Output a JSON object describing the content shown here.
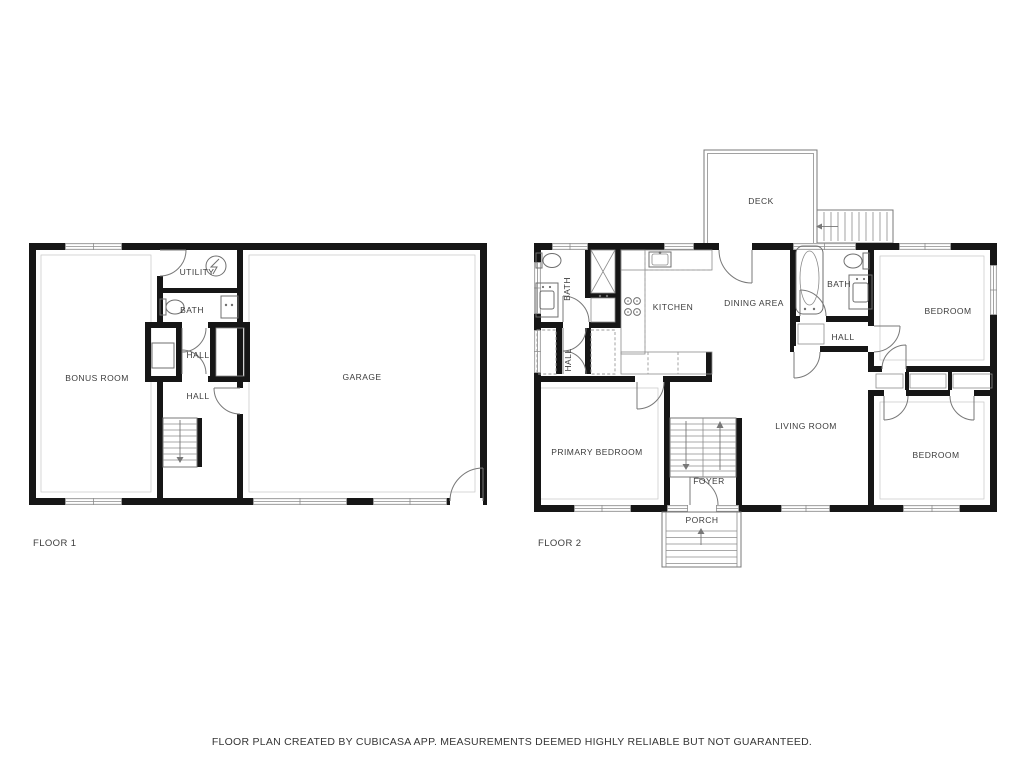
{
  "footer": {
    "disclaimer": "FLOOR PLAN CREATED BY CUBICASA APP. MEASUREMENTS DEEMED HIGHLY RELIABLE BUT NOT GUARANTEED."
  },
  "floor1": {
    "label": "FLOOR 1",
    "rooms": {
      "bonus": {
        "label": "BONUS ROOM"
      },
      "utility": {
        "label": "UTILITY"
      },
      "bath": {
        "label": "BATH"
      },
      "hall_upper": {
        "label": "HALL"
      },
      "hall_lower": {
        "label": "HALL"
      },
      "garage": {
        "label": "GARAGE"
      }
    }
  },
  "floor2": {
    "label": "FLOOR 2",
    "rooms": {
      "deck": {
        "label": "DECK"
      },
      "bath_left": {
        "label": "BATH"
      },
      "hall_left": {
        "label": "HALL"
      },
      "kitchen": {
        "label": "KITCHEN"
      },
      "dining": {
        "label": "DINING AREA"
      },
      "bath_right": {
        "label": "BATH"
      },
      "hall_right": {
        "label": "HALL"
      },
      "bedroom_top": {
        "label": "BEDROOM"
      },
      "primary": {
        "label": "PRIMARY BEDROOM"
      },
      "living": {
        "label": "LIVING ROOM"
      },
      "foyer": {
        "label": "FOYER"
      },
      "bedroom_bottom": {
        "label": "BEDROOM"
      },
      "porch": {
        "label": "PORCH"
      }
    }
  },
  "icons": {
    "toilet-icon": "bowl-ellipse-with-tank",
    "bathtub-icon": "rounded-rect-with-inner-oval",
    "sink-icon": "rect-with-inner-basin",
    "stove-icon": "four-burner-circles",
    "water-heater-icon": "circle-with-bolt",
    "washer-closet-icon": "x-box",
    "stairs-up-arrow": "up-triangle",
    "stairs-down-arrow": "down-triangle",
    "deck-stairs-arrow": "left-triangle"
  },
  "colors": {
    "wall": "#161616",
    "thin_line": "#787878",
    "text": "#3c3c3c",
    "background": "#ffffff"
  }
}
